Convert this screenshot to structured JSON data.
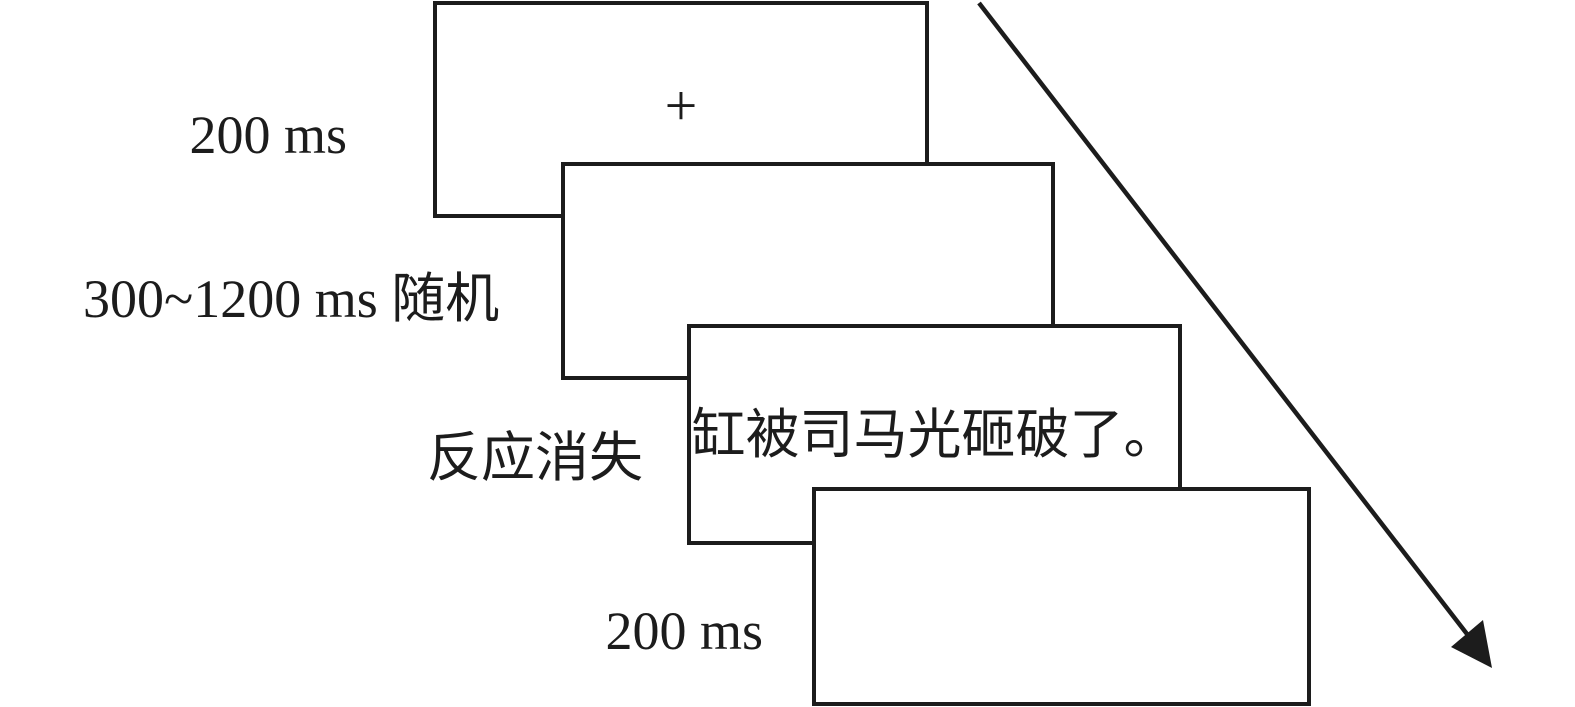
{
  "colors": {
    "ink": "#1c1c1c",
    "background": "#ffffff"
  },
  "diagram": {
    "type": "experiment-trial-sequence",
    "screens": [
      {
        "name": "fixation-screen",
        "content": "+",
        "duration_label": "200 ms"
      },
      {
        "name": "blank-screen-1",
        "content": "",
        "duration_label": "300~1200 ms 随机"
      },
      {
        "name": "sentence-screen",
        "content": "缸被司马光砸破了。",
        "duration_label": "反应消失"
      },
      {
        "name": "blank-screen-2",
        "content": "",
        "duration_label": "200 ms"
      }
    ],
    "arrow": {
      "name": "time-arrow",
      "direction": "top-right-to-bottom-right"
    }
  }
}
